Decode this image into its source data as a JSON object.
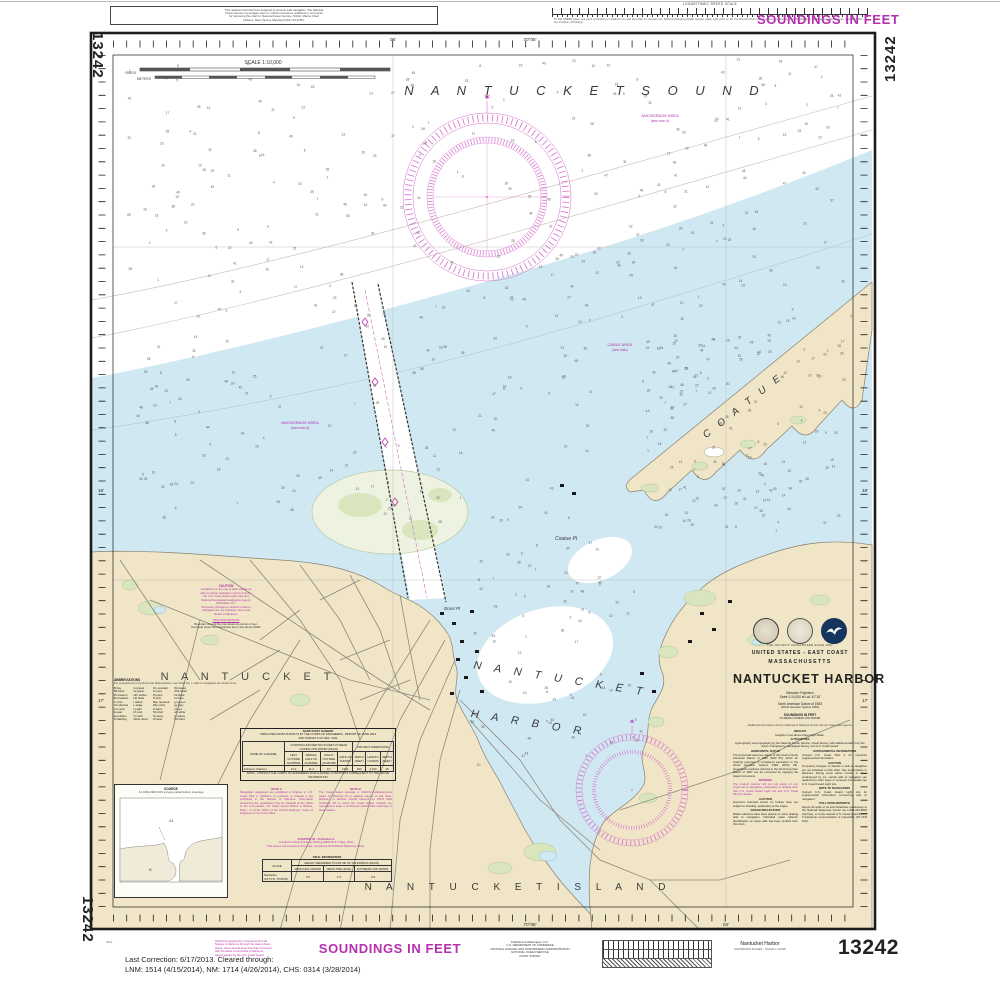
{
  "chart_number": "13242",
  "header": {
    "note_box_lines": [
      "This nautical chart has been designed to promote safe navigation.  The National",
      "Ocean Service encourages users to submit corrections, additions or comments",
      "for improving this chart to: National Ocean Service, NOAA, Marine Chart",
      "Division, Silver Spring, Maryland (301-713-2780)."
    ],
    "speed_scale_title": "LOGARITHMIC SPEED SCALE",
    "speed_scale_note1": "To find SPEED place one point of dividers on distance run and the other on minutes run. Without changing divider spread, place right point on 60;",
    "speed_scale_note2": "the left point then marks speed in knots. To find DISTANCE or TIME reverse the process. (see Bowditch, the practice of Plotting)",
    "soundings": "SOUNDINGS IN FEET"
  },
  "scale_bar": {
    "title": "SCALE 1:10,000",
    "units_top": "YARDS",
    "units_bottom": "METERS"
  },
  "map_labels": {
    "sound": "N A N T U C K E T    S O U N D",
    "harbor1": "N A N T U C K E T",
    "harbor2": "H A R B O R",
    "coatue": "C O A T U E",
    "town": "N A N T U C K E T",
    "island": "N A N T U C K E T    I S L A N D",
    "coatue_pt": "Coatue Pt",
    "brant_pt": "Brant Pt"
  },
  "water_notes": [
    {
      "l1": "ANCHORAGE AREA",
      "l2": "(see note A)"
    },
    {
      "l1": "ANCHORAGE AREA",
      "l2": "(see note A)"
    },
    {
      "l1": "CABLE AREA",
      "l2": "(see note)"
    }
  ],
  "edge_labels": {
    "top": "70°05'",
    "top_b": "06'",
    "bottom": "70°05'",
    "bottom_b": "04'",
    "left_a": "18'",
    "left_b": "17'",
    "right_a": "18'",
    "right_b": "17'"
  },
  "title_block": {
    "tagline": "THE NATION'S CHARTMAKER SINCE 1807",
    "region": "UNITED STATES - EAST COAST",
    "state": "MASSACHUSETTS",
    "title": "NANTUCKET HARBOR",
    "projection": "Mercator Projection",
    "scale": "Scale 1:10,000 at Lat. 41°18'",
    "datum": "North American Datum of 1983",
    "datum2": "(World Geodetic System 1984)",
    "soundings": "SOUNDINGS IN FEET",
    "soundings2": "AT MEAN LOWER LOW WATER",
    "gps_note": "Additional information can be obtained at National Ocean Service chart sales agents.",
    "heights_head": "HEIGHTS",
    "heights_body": "Heights in feet above Mean High Water.",
    "auth_head": "AUTHORITIES",
    "auth_body": "Hydrography and topography by the National Ocean Service, Coast Survey, with additional data from the Corps of Engineers, Geological Survey, and U.S. Coast Guard.",
    "lh1": "HORIZONTAL DATUM",
    "lb1": "The horizontal reference datum of this chart is North American Datum of 1983 (NAD 83), which for charting purposes is considered equivalent to the World Geodetic System 1984 (WGS 84). Geographic positions referred to the North American Datum of 1927 can be converted by applying the stated corrections.",
    "lh2": "WARNING",
    "lb2": "The prudent mariner will not rely solely on any single aid to navigation, particularly on floating aids. See U.S. Coast Guard Light List and U.S. Coast Pilot for details.",
    "lh3": "CAUTION",
    "lb3": "Improved channels shown by broken lines are subject to shoaling, particularly at the edges.",
    "lh4": "RADAR REFLECTORS",
    "lb4": "Radar reflectors have been placed on many floating aids to navigation. Individual radar reflector identification on these aids has been omitted from this chart.",
    "rh1": "SUPPLEMENTAL INFORMATION",
    "rb1": "Consult U.S. Coast Pilot 2 for important supplemental information.",
    "rh2": "CAUTION",
    "rb2": "Temporary changes or defects in aids to navigation are not indicated on this chart. See Local Notice to Mariners. During some winter months or when endangered by ice, certain aids to navigation are replaced by other types or removed. For details see U.S. Coast Guard Light List.",
    "rh3": "NOTE TO NAVIGATORS",
    "rb3": "Consult U.S. Coast Guard Light List for supplemental information concerning aids to navigation.",
    "rh4": "POLLUTION REPORTS",
    "rb4": "Report all spills of oil and hazardous substances to the National Response Center via 1-800-424-8802 (toll free), or to the nearest U.S. Coast Guard facility if telephone communication is impossible (33 CFR 153)."
  },
  "left_notes": {
    "caution_heading": "CAUTION",
    "caution_lines": [
      "Limitations on the use of radio signals as",
      "aids to marine navigation can be found in",
      "the U.S. Coast Guard Light Lists and",
      "National Geospatial-Intelligence Agency",
      "Publication 117.",
      "Temporary changes or defects in aids to",
      "navigation are not indicated.  See Local",
      "Notice to Mariners."
    ],
    "datum_note1": "TIDAL DATUM NOTE",
    "datum_note2": "Boundary lines of the may areas are shown in feet.",
    "datum_note3": "Overhead power line clearances are in feet above MHW.",
    "abbr_title": "ABBREVIATIONS",
    "abbr_intro": "For complete list of symbols and abbreviations, see Chart No. 1.  Aids to navigation are shown thus:",
    "abbr_c1": [
      "B bay",
      "Bk bank",
      "Bn beacon",
      "Br breakers",
      "C cove",
      "Ch channel",
      "Co coral",
      "E east",
      "Ed edition",
      "Fl flashing"
    ],
    "abbr_c2": [
      "G gravel",
      "Gt great",
      "Hbr harbor",
      "Hd head",
      "I island",
      "L ledge",
      "Lt light",
      "M mud",
      "N north",
      "Obstr obstn"
    ],
    "abbr_c3": [
      "Oc occulted",
      "P pond",
      "Pt point",
      "R rock",
      "Rep reported",
      "Rky rocky",
      "S sand",
      "Sh shell",
      "St stone",
      "W west"
    ],
    "abbr_c4": [
      "Wd weed",
      "Whf wharf",
      "bk black",
      "bu blue",
      "gn green",
      "gy gray",
      "rd red",
      "wh white",
      "yl yellow",
      "hrd hard"
    ]
  },
  "anchorage_table": {
    "t1": "NANTUCKET HARBOR",
    "t2": "TABULATED FROM SURVEYS BY THE CORPS OF ENGINEERS - REPORT OF JUNE 2013",
    "t3": "AND SURVEYS OF DEC. 2011",
    "h_left": "CONTROLLING DEPTHS IN FEET AT MEAN LOWER LOW WATER (MLLW)",
    "h_right": "PROJECT DIMENSIONS",
    "c0": "NAME OF CHANNEL",
    "c1": "LEFT OUTSIDE QUARTER",
    "c2": "MIDDLE HALF OF CHANNEL",
    "c3": "RIGHT OUTSIDE QUARTER",
    "c4": "DATE OF SURVEY",
    "c5": "WIDTH (FEET)",
    "c6": "LENGTH (YARDS)",
    "c7": "DEPTH (FEET)",
    "r0": "Entrance Channel",
    "r1": "10.2",
    "r2": "11.4",
    "r3": "9.7",
    "r4": "12/11",
    "r5": "300",
    "r6": "2,100",
    "r7": "15",
    "note": "NOTE - CONSULT THE CORPS OF ENGINEERS FOR CHANNEL CONDITIONS SUBSEQUENT TO THE ABOVE INFORMATION"
  },
  "notes_ab": {
    "a_head": "NOTE A",
    "a_body": "Navigation regulations are published in Chapter 2, U.S. Coast Pilot 2.  Additions or revisions to Chapter 2 are published in the Notices to Mariners.  Information concerning the regulations may be obtained at the Office of the Commander, 1st Coast Guard District in Boston, Mass., or at the Office of the District Engineer, Corps of Engineers in Concord, Mass.",
    "b_head": "NOTE B",
    "b_body": "The Coast Guard operates a VHF-FM radiotelephone watch on Channel 16 at stations shown on this chart.  Mariners in distress should transmit on 156.8 MHz (Channel 16) to reach the Coast Guard.  Vessels are requested to keep a continuous watch while underway in these waters.",
    "c_line1": "CHARTED 30 - 40  Section A",
    "c_line2": "Locations of Reg Points for Plotting (9960-W & X  Reg. 18-F)",
    "c_line3": "This area is not covered at this scale; consult the NOS/NOAA Reference Chart."
  },
  "tidal_table": {
    "title": "TIDAL INFORMATION",
    "place": "PLACE",
    "h_group": "HEIGHT REFERRED TO DATUM OF SOUNDINGS (MLLW)",
    "h1": "MEAN HIGH WATER",
    "h2": "MEAN TIDE LEVEL",
    "h3": "EXTREME LOW WATER",
    "r_name": "Nantucket",
    "r_pos": "(41°17'N, 70°06'W)",
    "v1": "3.0",
    "v2": "1.5",
    "v3": "-3.5"
  },
  "source_inset": {
    "title": "SOURCE",
    "caption": "A1   1940-1990   NOS surveys   partial bottom coverage"
  },
  "footer": {
    "note_lines": [
      "NOAA has applied the corrections from all",
      "Notices to Mariners through the dates shown",
      "below.  Users should keep this chart corrected",
      "with the latest Local Notice to Mariners,",
      "issued weekly by the U.S. Coast Guard."
    ],
    "soundings": "SOUNDINGS IN FEET",
    "publisher": [
      "Published at Washington, D.C.",
      "U.S. DEPARTMENT OF COMMERCE",
      "NATIONAL OCEANIC AND ATMOSPHERIC ADMINISTRATION",
      "NATIONAL OCEAN SERVICE",
      "COAST SURVEY"
    ],
    "product_name": "Nantucket Harbor",
    "product_sub": "SOUNDINGS IN FEET - SCALE 1:10,000",
    "corr1": "Last Correction: 6/17/2013.  Cleared through:",
    "corr2": "LNM: 1514 (4/15/2014), NM: 1714 (4/26/2014), CHS: 0314 (3/28/2014)",
    "plate_note": "4601"
  }
}
